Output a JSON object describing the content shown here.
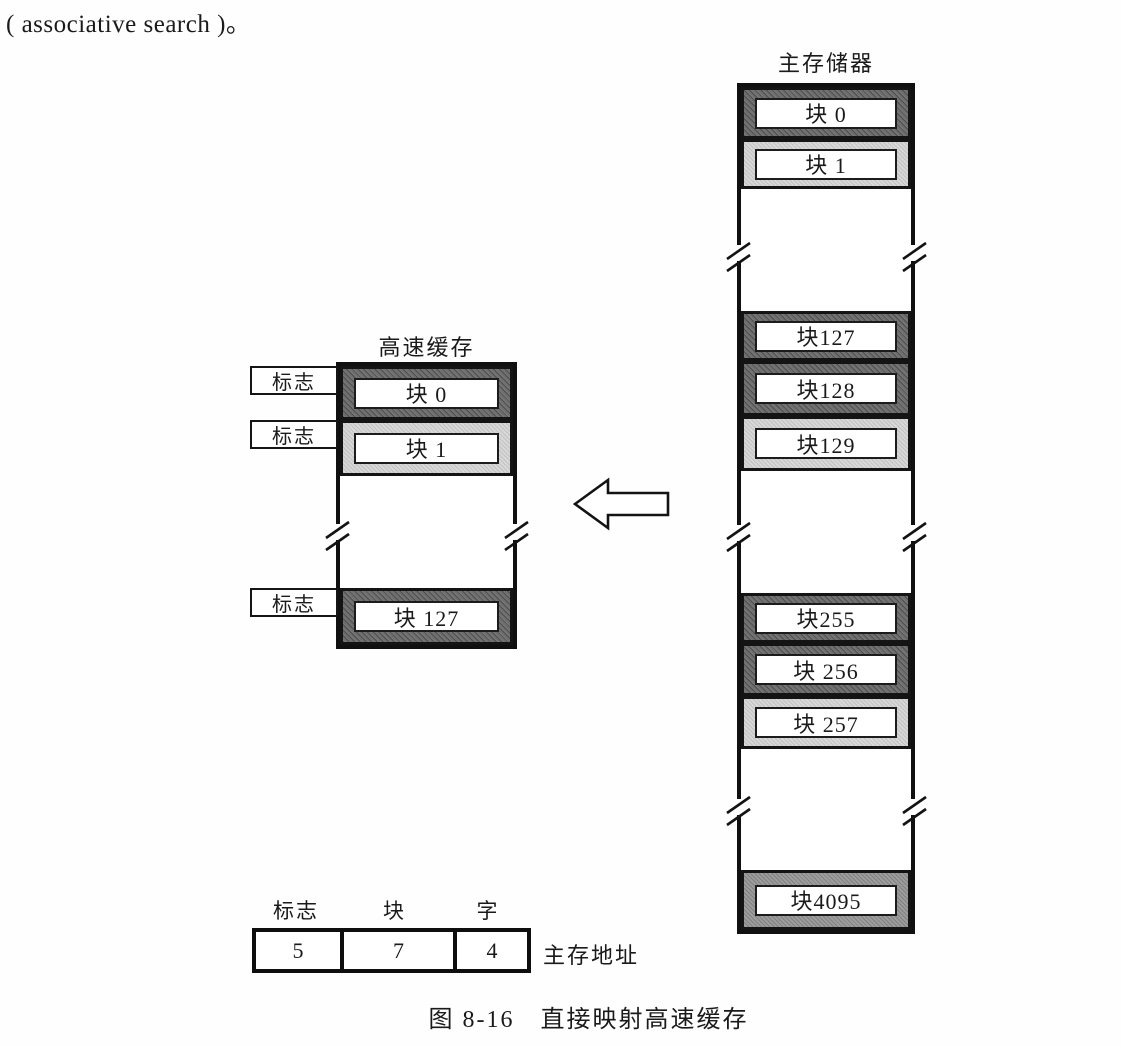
{
  "colors": {
    "block_dark": "#6e6e6e",
    "block_light": "#d8d8d8",
    "block_medium": "#9d9d9d",
    "line": "#101010"
  },
  "page": {
    "top_text": "( associative search )。",
    "figure_caption": "图 8-16　直接映射高速缓存"
  },
  "cache": {
    "title": "高速缓存",
    "tags": [
      {
        "label": "标志"
      },
      {
        "label": "标志"
      },
      {
        "label": "标志"
      }
    ],
    "blocks": [
      {
        "label": "块 0"
      },
      {
        "label": "块 1"
      },
      {
        "label": "块 127"
      }
    ]
  },
  "main_memory": {
    "title": "主存储器",
    "blocks": [
      {
        "label": "块 0"
      },
      {
        "label": "块 1"
      },
      {
        "label": "块127"
      },
      {
        "label": "块128"
      },
      {
        "label": "块129"
      },
      {
        "label": "块255"
      },
      {
        "label": "块 256"
      },
      {
        "label": "块 257"
      },
      {
        "label": "块4095"
      }
    ]
  },
  "address_format": {
    "fields": [
      {
        "label": "标志",
        "bits": "5"
      },
      {
        "label": "块",
        "bits": "7"
      },
      {
        "label": "字",
        "bits": "4"
      }
    ],
    "caption": "主存地址"
  }
}
